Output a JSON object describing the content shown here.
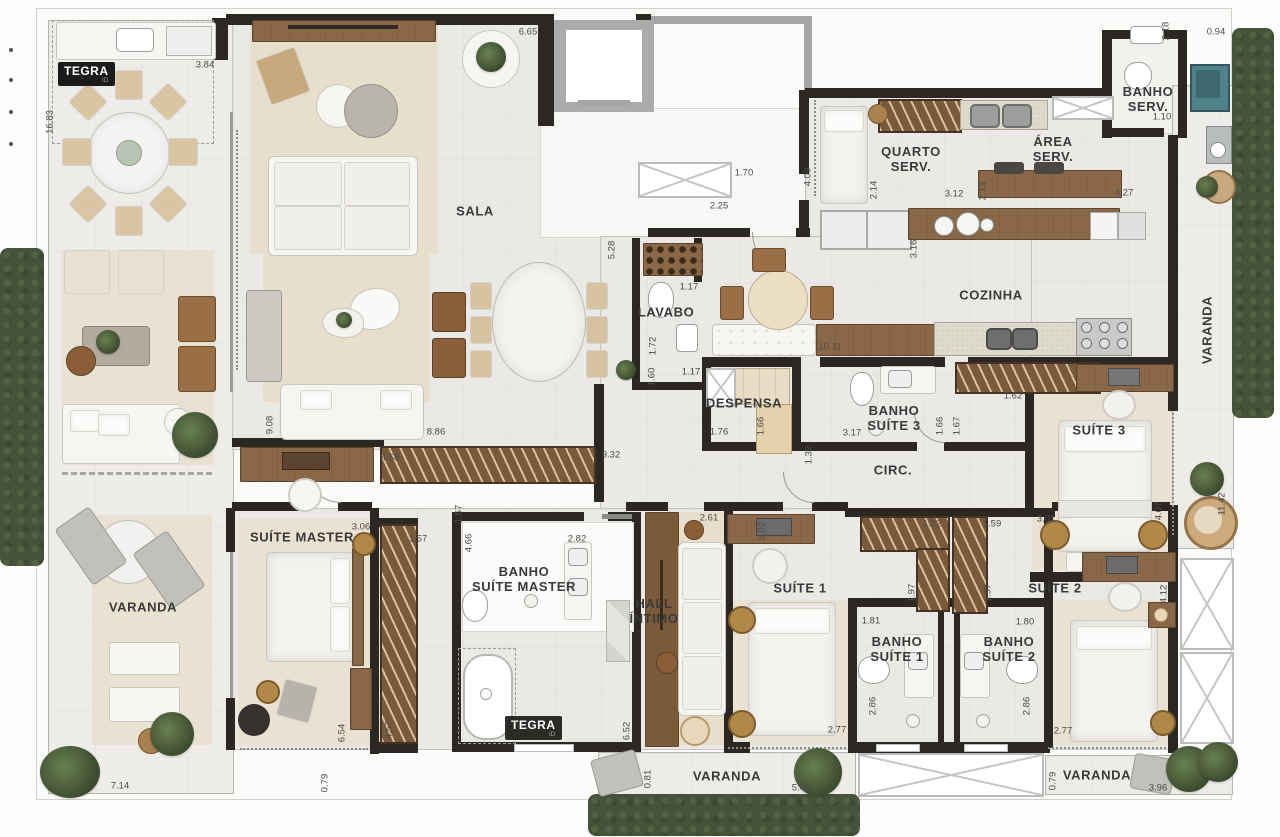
{
  "meta": {
    "brand": "TEGRA",
    "brand_sub": "ID"
  },
  "colors": {
    "wall": "#2b2824",
    "floor": "#eae9e5",
    "rug_beige": "#e7dfcc",
    "wood": "#8a6746",
    "hedge_green": "#45533a",
    "laundry_teal": "#4f8289",
    "granite": "#dedacd",
    "logo_bg": "#1b1b19"
  },
  "room_labels": [
    {
      "id": "sala",
      "text": "SALA",
      "x": 475,
      "y": 212
    },
    {
      "id": "lavabo",
      "text": "LAVABO",
      "x": 666,
      "y": 313
    },
    {
      "id": "cozinha",
      "text": "COZINHA",
      "x": 991,
      "y": 296
    },
    {
      "id": "quarto-serv",
      "text": "QUARTO\nSERV.",
      "x": 911,
      "y": 160
    },
    {
      "id": "area-serv",
      "text": "ÁREA\nSERV.",
      "x": 1053,
      "y": 150
    },
    {
      "id": "banho-serv",
      "text": "BANHO\nSERV.",
      "x": 1148,
      "y": 100
    },
    {
      "id": "despensa",
      "text": "DESPENSA",
      "x": 744,
      "y": 404
    },
    {
      "id": "banho-suite-3",
      "text": "BANHO\nSUÍTE 3",
      "x": 894,
      "y": 419
    },
    {
      "id": "circ",
      "text": "CIRC.",
      "x": 893,
      "y": 471
    },
    {
      "id": "suite-3",
      "text": "SUÍTE 3",
      "x": 1099,
      "y": 431
    },
    {
      "id": "suite-master",
      "text": "SUÍTE MASTER",
      "x": 302,
      "y": 538
    },
    {
      "id": "varanda-left",
      "text": "VARANDA",
      "x": 143,
      "y": 608
    },
    {
      "id": "banho-suite-master",
      "text": "BANHO\nSUÍTE MASTER",
      "x": 524,
      "y": 580
    },
    {
      "id": "hall-intimo",
      "text": "HALL\nÍNTIMO",
      "x": 654,
      "y": 612
    },
    {
      "id": "suite-1",
      "text": "SUÍTE 1",
      "x": 800,
      "y": 589
    },
    {
      "id": "banho-suite-1",
      "text": "BANHO\nSUÍTE 1",
      "x": 897,
      "y": 650
    },
    {
      "id": "banho-suite-2",
      "text": "BANHO\nSUÍTE 2",
      "x": 1009,
      "y": 650
    },
    {
      "id": "suite-2",
      "text": "SUÍTE 2",
      "x": 1055,
      "y": 589
    },
    {
      "id": "varanda-right",
      "text": "VARANDA",
      "x": 1208,
      "y": 330,
      "rot": -90
    },
    {
      "id": "varanda-bottom",
      "text": "VARANDA",
      "x": 727,
      "y": 777
    },
    {
      "id": "varanda-bottom-right",
      "text": "VARANDA",
      "x": 1097,
      "y": 776
    }
  ],
  "dim_labels": [
    {
      "t": "3.84",
      "x": 205,
      "y": 65
    },
    {
      "t": "16.83",
      "x": 50,
      "y": 122,
      "v": true
    },
    {
      "t": "6.65",
      "x": 528,
      "y": 32
    },
    {
      "t": "1.70",
      "x": 744,
      "y": 173
    },
    {
      "t": "4.09",
      "x": 808,
      "y": 177,
      "v": true
    },
    {
      "t": "2.25",
      "x": 719,
      "y": 206
    },
    {
      "t": "2.14",
      "x": 874,
      "y": 190,
      "v": true
    },
    {
      "t": "3.12",
      "x": 954,
      "y": 194
    },
    {
      "t": "2.13",
      "x": 983,
      "y": 191,
      "v": true
    },
    {
      "t": "4.27",
      "x": 1124,
      "y": 193
    },
    {
      "t": "2.18",
      "x": 1166,
      "y": 31,
      "v": true
    },
    {
      "t": "0.94",
      "x": 1216,
      "y": 32
    },
    {
      "t": "1.10",
      "x": 1162,
      "y": 117
    },
    {
      "t": "3.16",
      "x": 914,
      "y": 249,
      "v": true
    },
    {
      "t": "10.11",
      "x": 830,
      "y": 347
    },
    {
      "t": "5.28",
      "x": 612,
      "y": 250,
      "v": true
    },
    {
      "t": "1.17",
      "x": 689,
      "y": 287
    },
    {
      "t": "1.72",
      "x": 653,
      "y": 346,
      "v": true
    },
    {
      "t": "1.60",
      "x": 652,
      "y": 377,
      "v": true
    },
    {
      "t": "1.17",
      "x": 691,
      "y": 372
    },
    {
      "t": "1.76",
      "x": 719,
      "y": 432
    },
    {
      "t": "1.66",
      "x": 761,
      "y": 426,
      "v": true
    },
    {
      "t": "3.17",
      "x": 852,
      "y": 433
    },
    {
      "t": "1.66",
      "x": 940,
      "y": 426,
      "v": true
    },
    {
      "t": "1.67",
      "x": 957,
      "y": 426,
      "v": true
    },
    {
      "t": "1.32",
      "x": 809,
      "y": 455,
      "v": true
    },
    {
      "t": "9.32",
      "x": 611,
      "y": 455
    },
    {
      "t": "8.86",
      "x": 436,
      "y": 432
    },
    {
      "t": "9.08",
      "x": 270,
      "y": 425,
      "v": true
    },
    {
      "t": "4.58",
      "x": 390,
      "y": 458
    },
    {
      "t": "3.06",
      "x": 361,
      "y": 527
    },
    {
      "t": "1.57",
      "x": 418,
      "y": 539
    },
    {
      "t": "4.57",
      "x": 389,
      "y": 730,
      "v": true
    },
    {
      "t": "4.66",
      "x": 469,
      "y": 543,
      "v": true
    },
    {
      "t": "2.82",
      "x": 577,
      "y": 539
    },
    {
      "t": "1.67",
      "x": 459,
      "y": 514,
      "v": true
    },
    {
      "t": "2.61",
      "x": 709,
      "y": 518
    },
    {
      "t": "5.02",
      "x": 762,
      "y": 531,
      "v": true
    },
    {
      "t": "1.82",
      "x": 932,
      "y": 524
    },
    {
      "t": "1.59",
      "x": 992,
      "y": 524
    },
    {
      "t": "1.97",
      "x": 912,
      "y": 593,
      "v": true
    },
    {
      "t": "1.97",
      "x": 988,
      "y": 593,
      "v": true
    },
    {
      "t": "3.01",
      "x": 1046,
      "y": 519
    },
    {
      "t": "4.07",
      "x": 1159,
      "y": 511,
      "v": true
    },
    {
      "t": "11.42",
      "x": 1222,
      "y": 504,
      "v": true
    },
    {
      "t": "1.62",
      "x": 1013,
      "y": 396
    },
    {
      "t": "6.54",
      "x": 342,
      "y": 733,
      "v": true
    },
    {
      "t": "0.79",
      "x": 325,
      "y": 783,
      "v": true
    },
    {
      "t": "7.14",
      "x": 120,
      "y": 786
    },
    {
      "t": "6.52",
      "x": 627,
      "y": 731,
      "v": true
    },
    {
      "t": "2.77",
      "x": 837,
      "y": 730
    },
    {
      "t": "2.86",
      "x": 873,
      "y": 706,
      "v": true
    },
    {
      "t": "2.86",
      "x": 1027,
      "y": 706,
      "v": true
    },
    {
      "t": "1.81",
      "x": 871,
      "y": 621
    },
    {
      "t": "1.80",
      "x": 1025,
      "y": 622
    },
    {
      "t": "2.77",
      "x": 1063,
      "y": 731
    },
    {
      "t": "4.12",
      "x": 1164,
      "y": 594,
      "v": true
    },
    {
      "t": "0.81",
      "x": 648,
      "y": 779,
      "v": true
    },
    {
      "t": "5.49",
      "x": 801,
      "y": 788
    },
    {
      "t": "0.79",
      "x": 1053,
      "y": 781,
      "v": true
    },
    {
      "t": "3.96",
      "x": 1158,
      "y": 788
    }
  ]
}
